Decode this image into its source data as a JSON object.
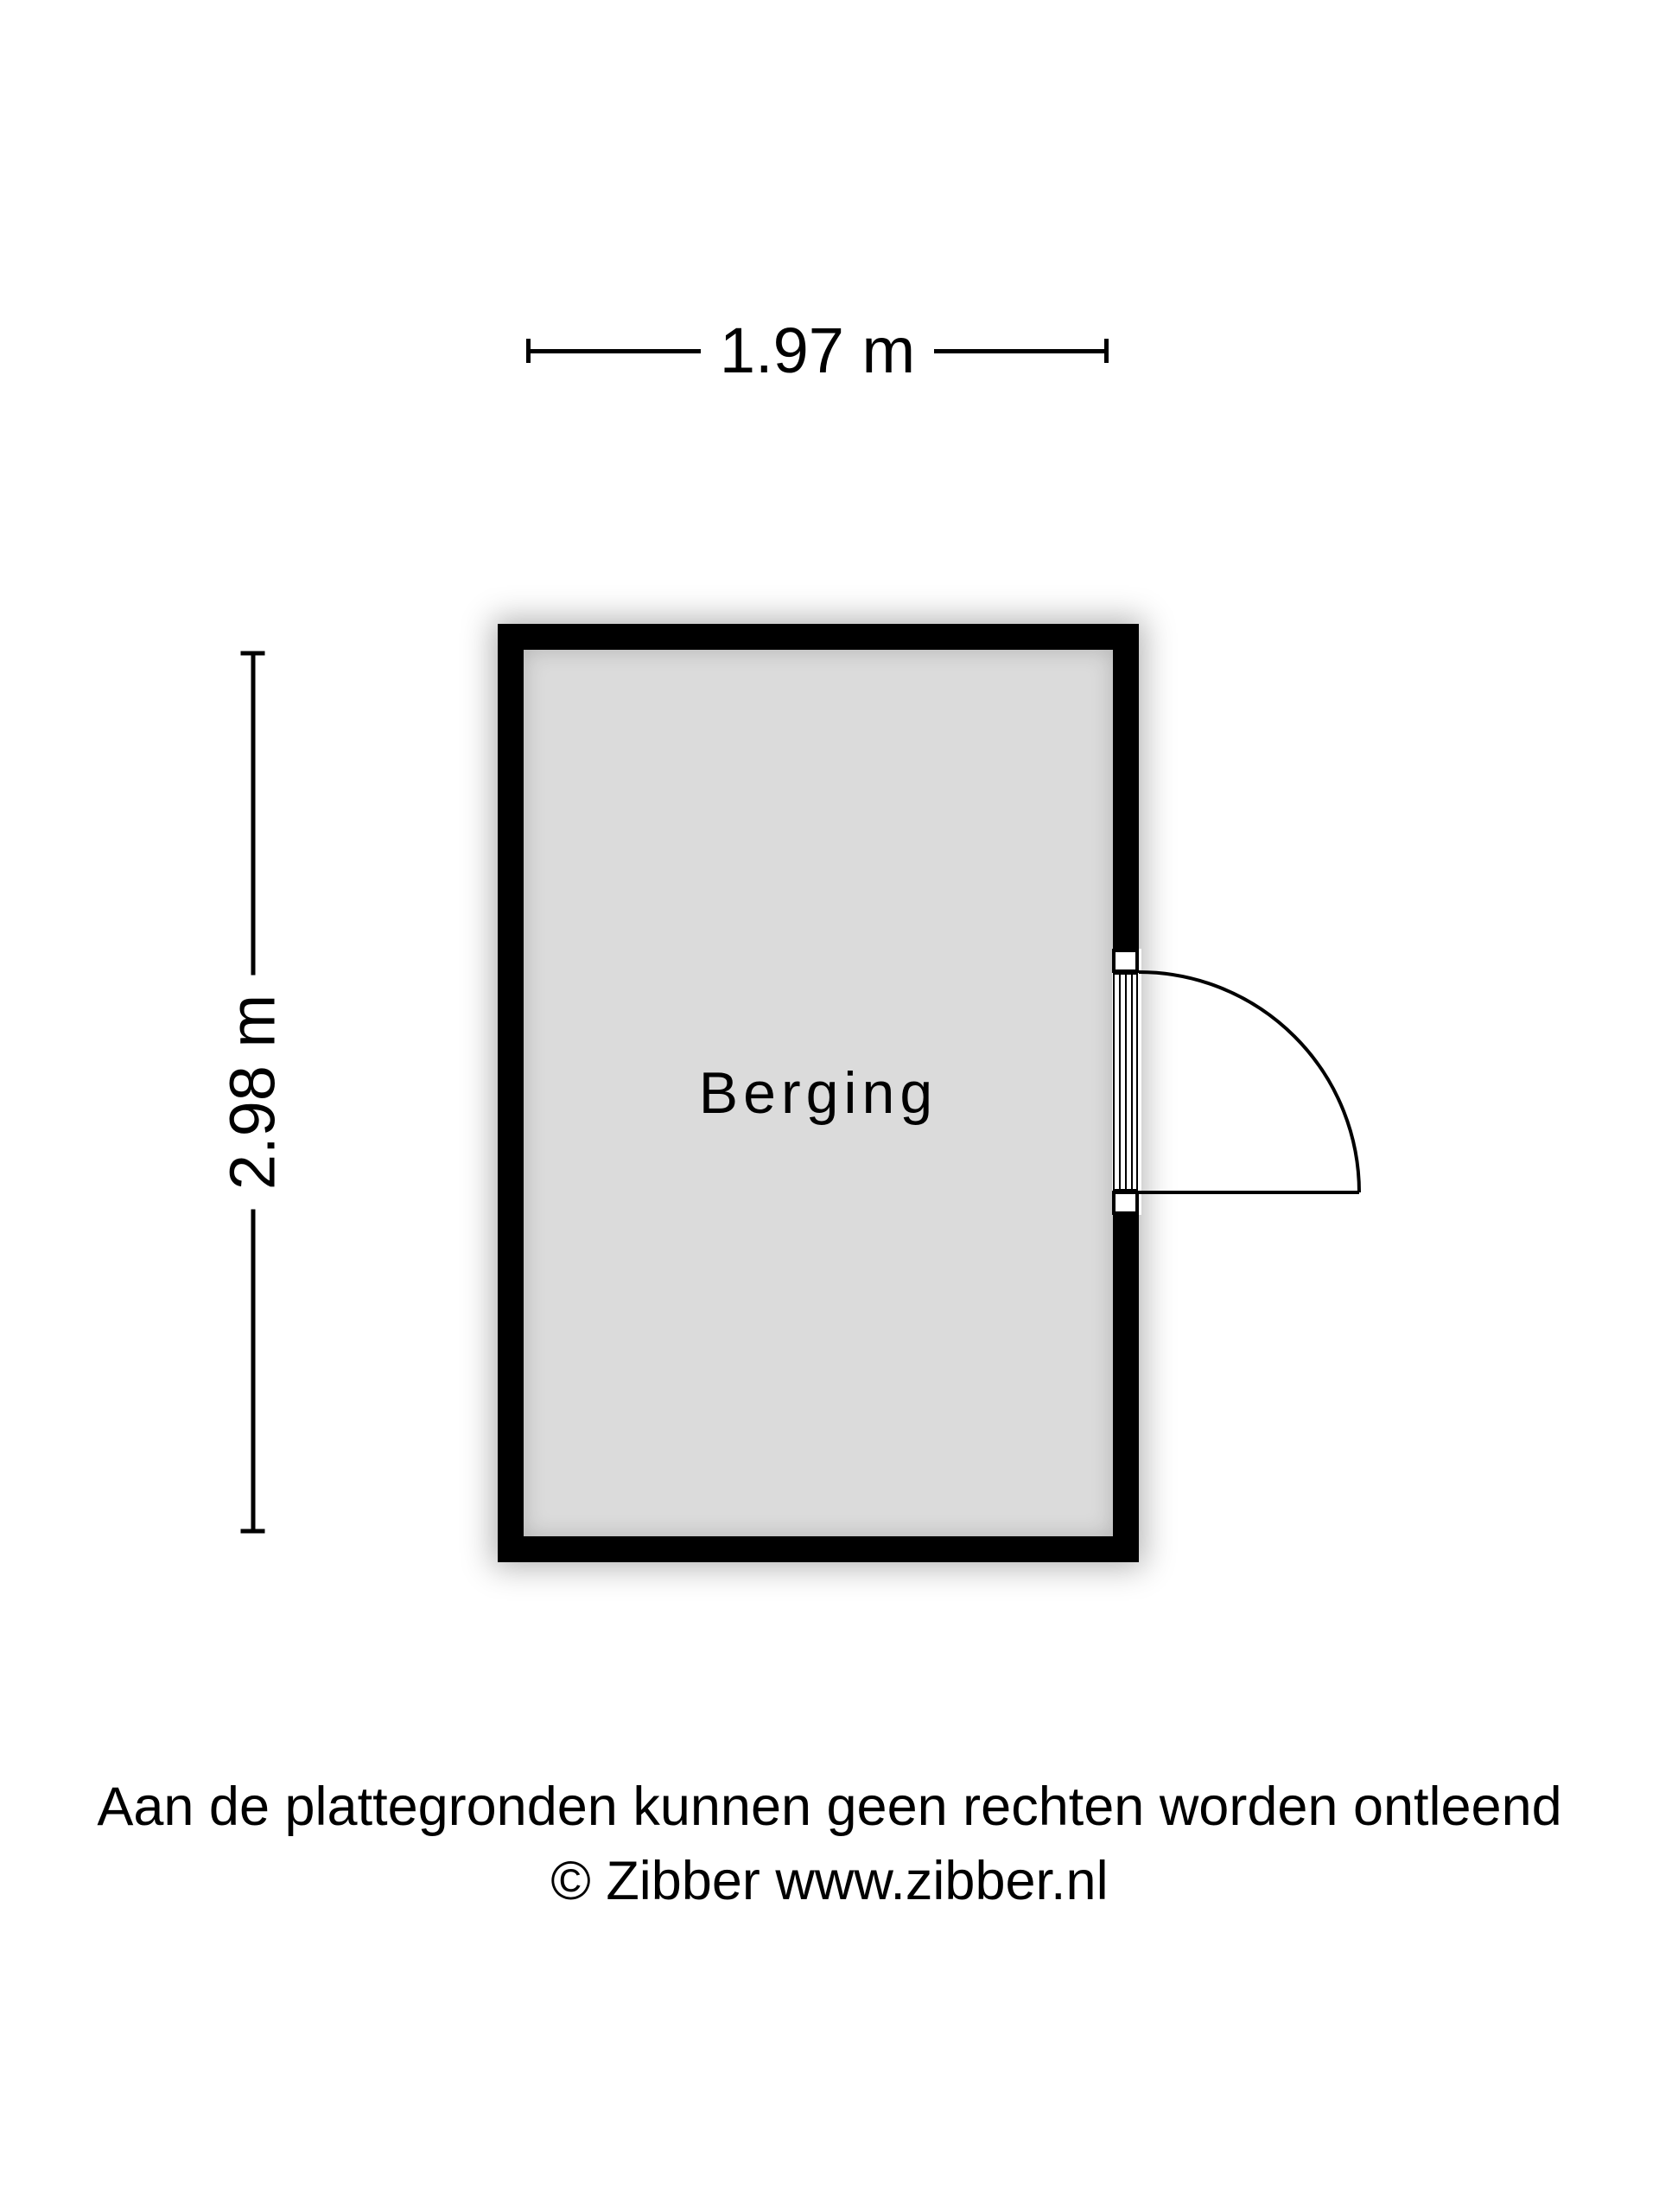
{
  "page": {
    "background_color": "#ffffff",
    "text_color": "#000000"
  },
  "floorplan": {
    "room": {
      "label": "Berging",
      "floor_color": "#dbdbdb",
      "wall_color": "#000000"
    },
    "dimensions": {
      "width_label": "1.97 m",
      "height_label": "2.98 m"
    },
    "door": {
      "wall": "right",
      "type": "single-swing-outward"
    }
  },
  "footer": {
    "line1": "Aan de plattegronden kunnen geen rechten worden ontleend",
    "line2": "© Zibber www.zibber.nl"
  }
}
